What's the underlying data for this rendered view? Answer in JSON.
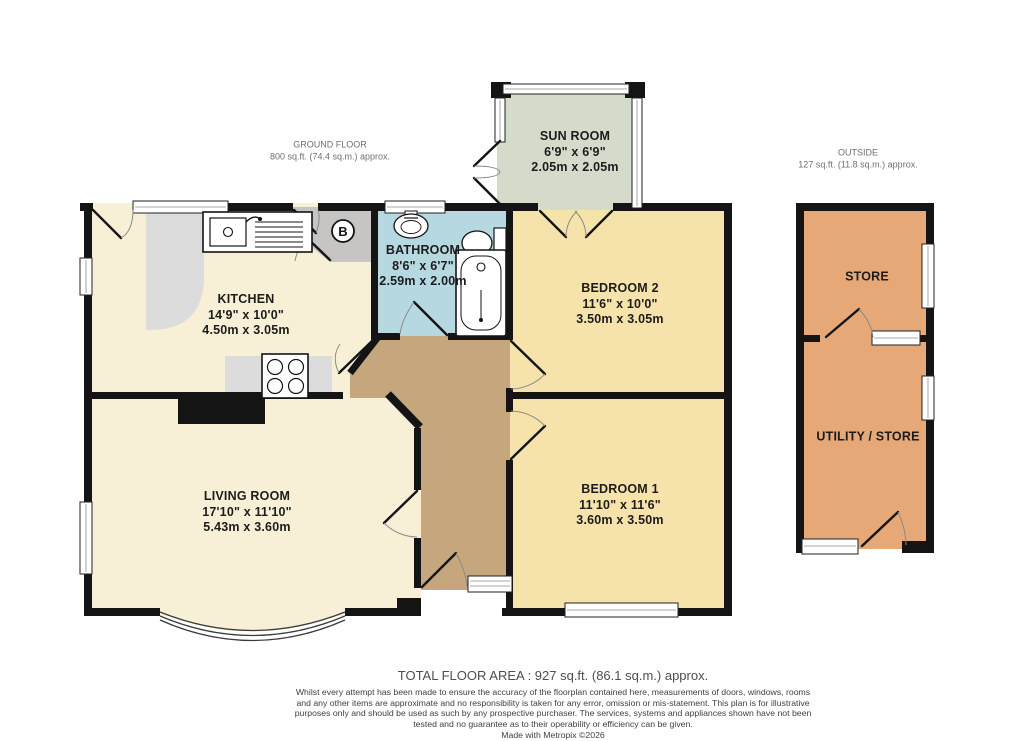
{
  "header": {
    "ground_floor": {
      "title": "GROUND FLOOR",
      "area": "800 sq.ft. (74.4 sq.m.) approx."
    },
    "outside": {
      "title": "OUTSIDE",
      "area": "127 sq.ft. (11.8 sq.m.) approx."
    }
  },
  "rooms": {
    "sun_room": {
      "name": "SUN ROOM",
      "imperial": "6'9\"  x 6'9\"",
      "metric": "2.05m  x 2.05m"
    },
    "kitchen": {
      "name": "KITCHEN",
      "imperial": "14'9\"  x 10'0\"",
      "metric": "4.50m  x 3.05m"
    },
    "bathroom": {
      "name": "BATHROOM",
      "imperial": "8'6\"  x 6'7\"",
      "metric": "2.59m  x 2.00m"
    },
    "bedroom2": {
      "name": "BEDROOM 2",
      "imperial": "11'6\"  x 10'0\"",
      "metric": "3.50m  x 3.05m"
    },
    "bedroom1": {
      "name": "BEDROOM 1",
      "imperial": "11'10\"  x 11'6\"",
      "metric": "3.60m  x 3.50m"
    },
    "living_room": {
      "name": "LIVING ROOM",
      "imperial": "17'10\"  x 11'10\"",
      "metric": "5.43m  x 3.60m"
    },
    "store": {
      "name": "STORE"
    },
    "utility": {
      "name": "UTILITY / STORE"
    }
  },
  "symbols": {
    "boiler": "B"
  },
  "footer": {
    "total_area": "TOTAL FLOOR AREA : 927 sq.ft. (86.1 sq.m.) approx.",
    "disclaimer": "Whilst every attempt has been made to ensure the accuracy of the floorplan contained here, measurements of doors, windows, rooms and any other items are approximate and no responsibility is taken for any error, omission or mis-statement. This plan is for illustrative purposes only and should be used as such by any prospective purchaser. The services, systems and appliances shown have not been tested and no guarantee as to their operability or efficiency can be given.",
    "credit": "Made with Metropix ©2026"
  },
  "colors": {
    "wall": "#141414",
    "cream_floor": "#f8f0d6",
    "bedroom_floor": "#f6e3ab",
    "sunroom_floor": "#d5dbca",
    "bathroom_floor": "#b6d8e1",
    "hall_floor": "#c6a67c",
    "outbuilding_floor": "#e6a877",
    "counter_gray": "#dcdcdc",
    "lobby_gray": "#c6c5c4"
  }
}
